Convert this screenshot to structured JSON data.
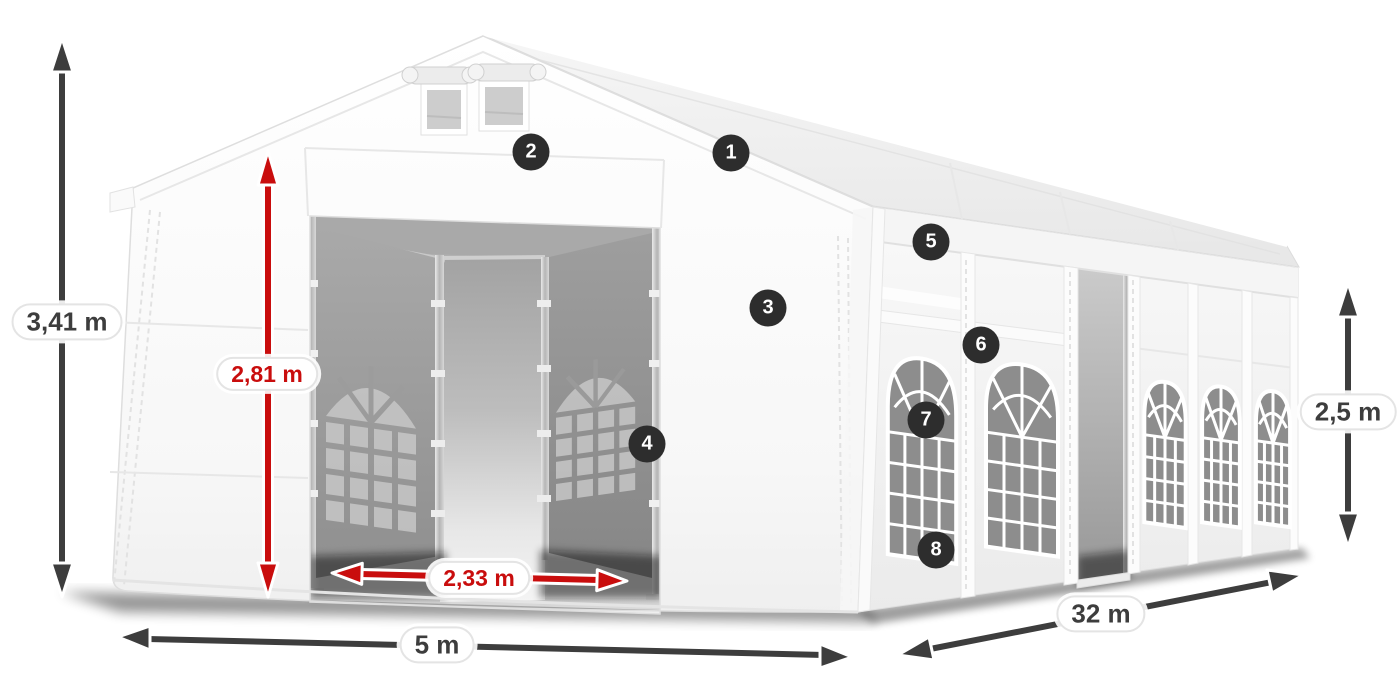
{
  "dimensions": {
    "total_height": "3,41 m",
    "entrance_height": "2,81 m",
    "entrance_width": "2,33 m",
    "width": "5 m",
    "length": "32 m",
    "side_height": "2,5 m"
  },
  "hotspots": [
    "1",
    "2",
    "3",
    "4",
    "5",
    "6",
    "7",
    "8"
  ],
  "colors": {
    "dimension_red": "#c90d0d",
    "dimension_dark": "#3d3d3d",
    "hotspot_bg": "#2d2d2d",
    "hotspot_text": "#ffffff",
    "background": "#ffffff"
  }
}
